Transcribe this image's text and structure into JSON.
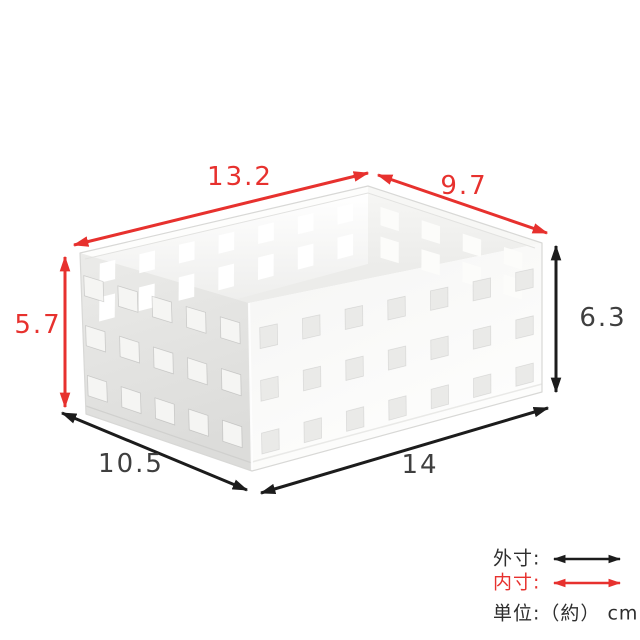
{
  "diagram": {
    "dims": {
      "inner_length": "13.2",
      "inner_depth": "9.7",
      "inner_height": "5.7",
      "outer_height": "6.3",
      "outer_depth": "10.5",
      "outer_length": "14"
    },
    "legend": {
      "outer": "外寸:",
      "inner": "内寸:",
      "unit": "単位:（約） cm"
    },
    "colors": {
      "inner_dim": "#e7312e",
      "outer_dim": "#1c1c1c"
    }
  }
}
